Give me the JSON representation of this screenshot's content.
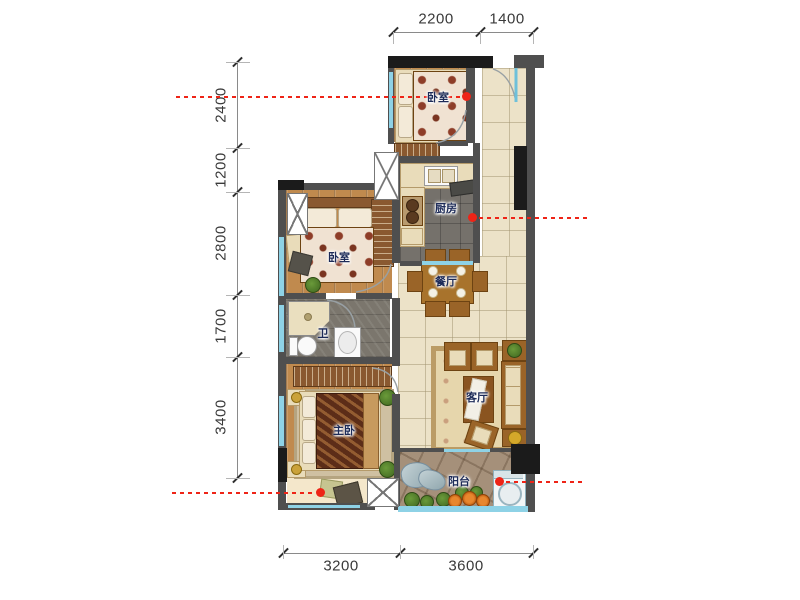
{
  "page": {
    "type": "apartment-floorplan"
  },
  "rooms": [
    {
      "id": "bedroom-top",
      "label": "卧室"
    },
    {
      "id": "kitchen",
      "label": "厨房"
    },
    {
      "id": "bedroom-mid",
      "label": "卧室"
    },
    {
      "id": "dining-room",
      "label": "餐厅"
    },
    {
      "id": "bathroom",
      "label": "卫"
    },
    {
      "id": "master-bedroom",
      "label": "主卧"
    },
    {
      "id": "living-room",
      "label": "客厅"
    },
    {
      "id": "balcony",
      "label": "阳台"
    }
  ],
  "dimensions_mm": {
    "top": [
      "2200",
      "1400"
    ],
    "left": [
      "2400",
      "1200",
      "2800",
      "1700",
      "3400"
    ],
    "bottom": [
      "3200",
      "3600"
    ]
  },
  "colors": {
    "wall": "#4f4f4f",
    "column": "#1b1b1b",
    "window": "#8ed2e6",
    "red_guide": "#ee2417",
    "wood_floor": "#c08a4e",
    "tile_floor": "#ece2c8",
    "dark_tile": "#75716b",
    "stone_floor": "#a5907a"
  }
}
